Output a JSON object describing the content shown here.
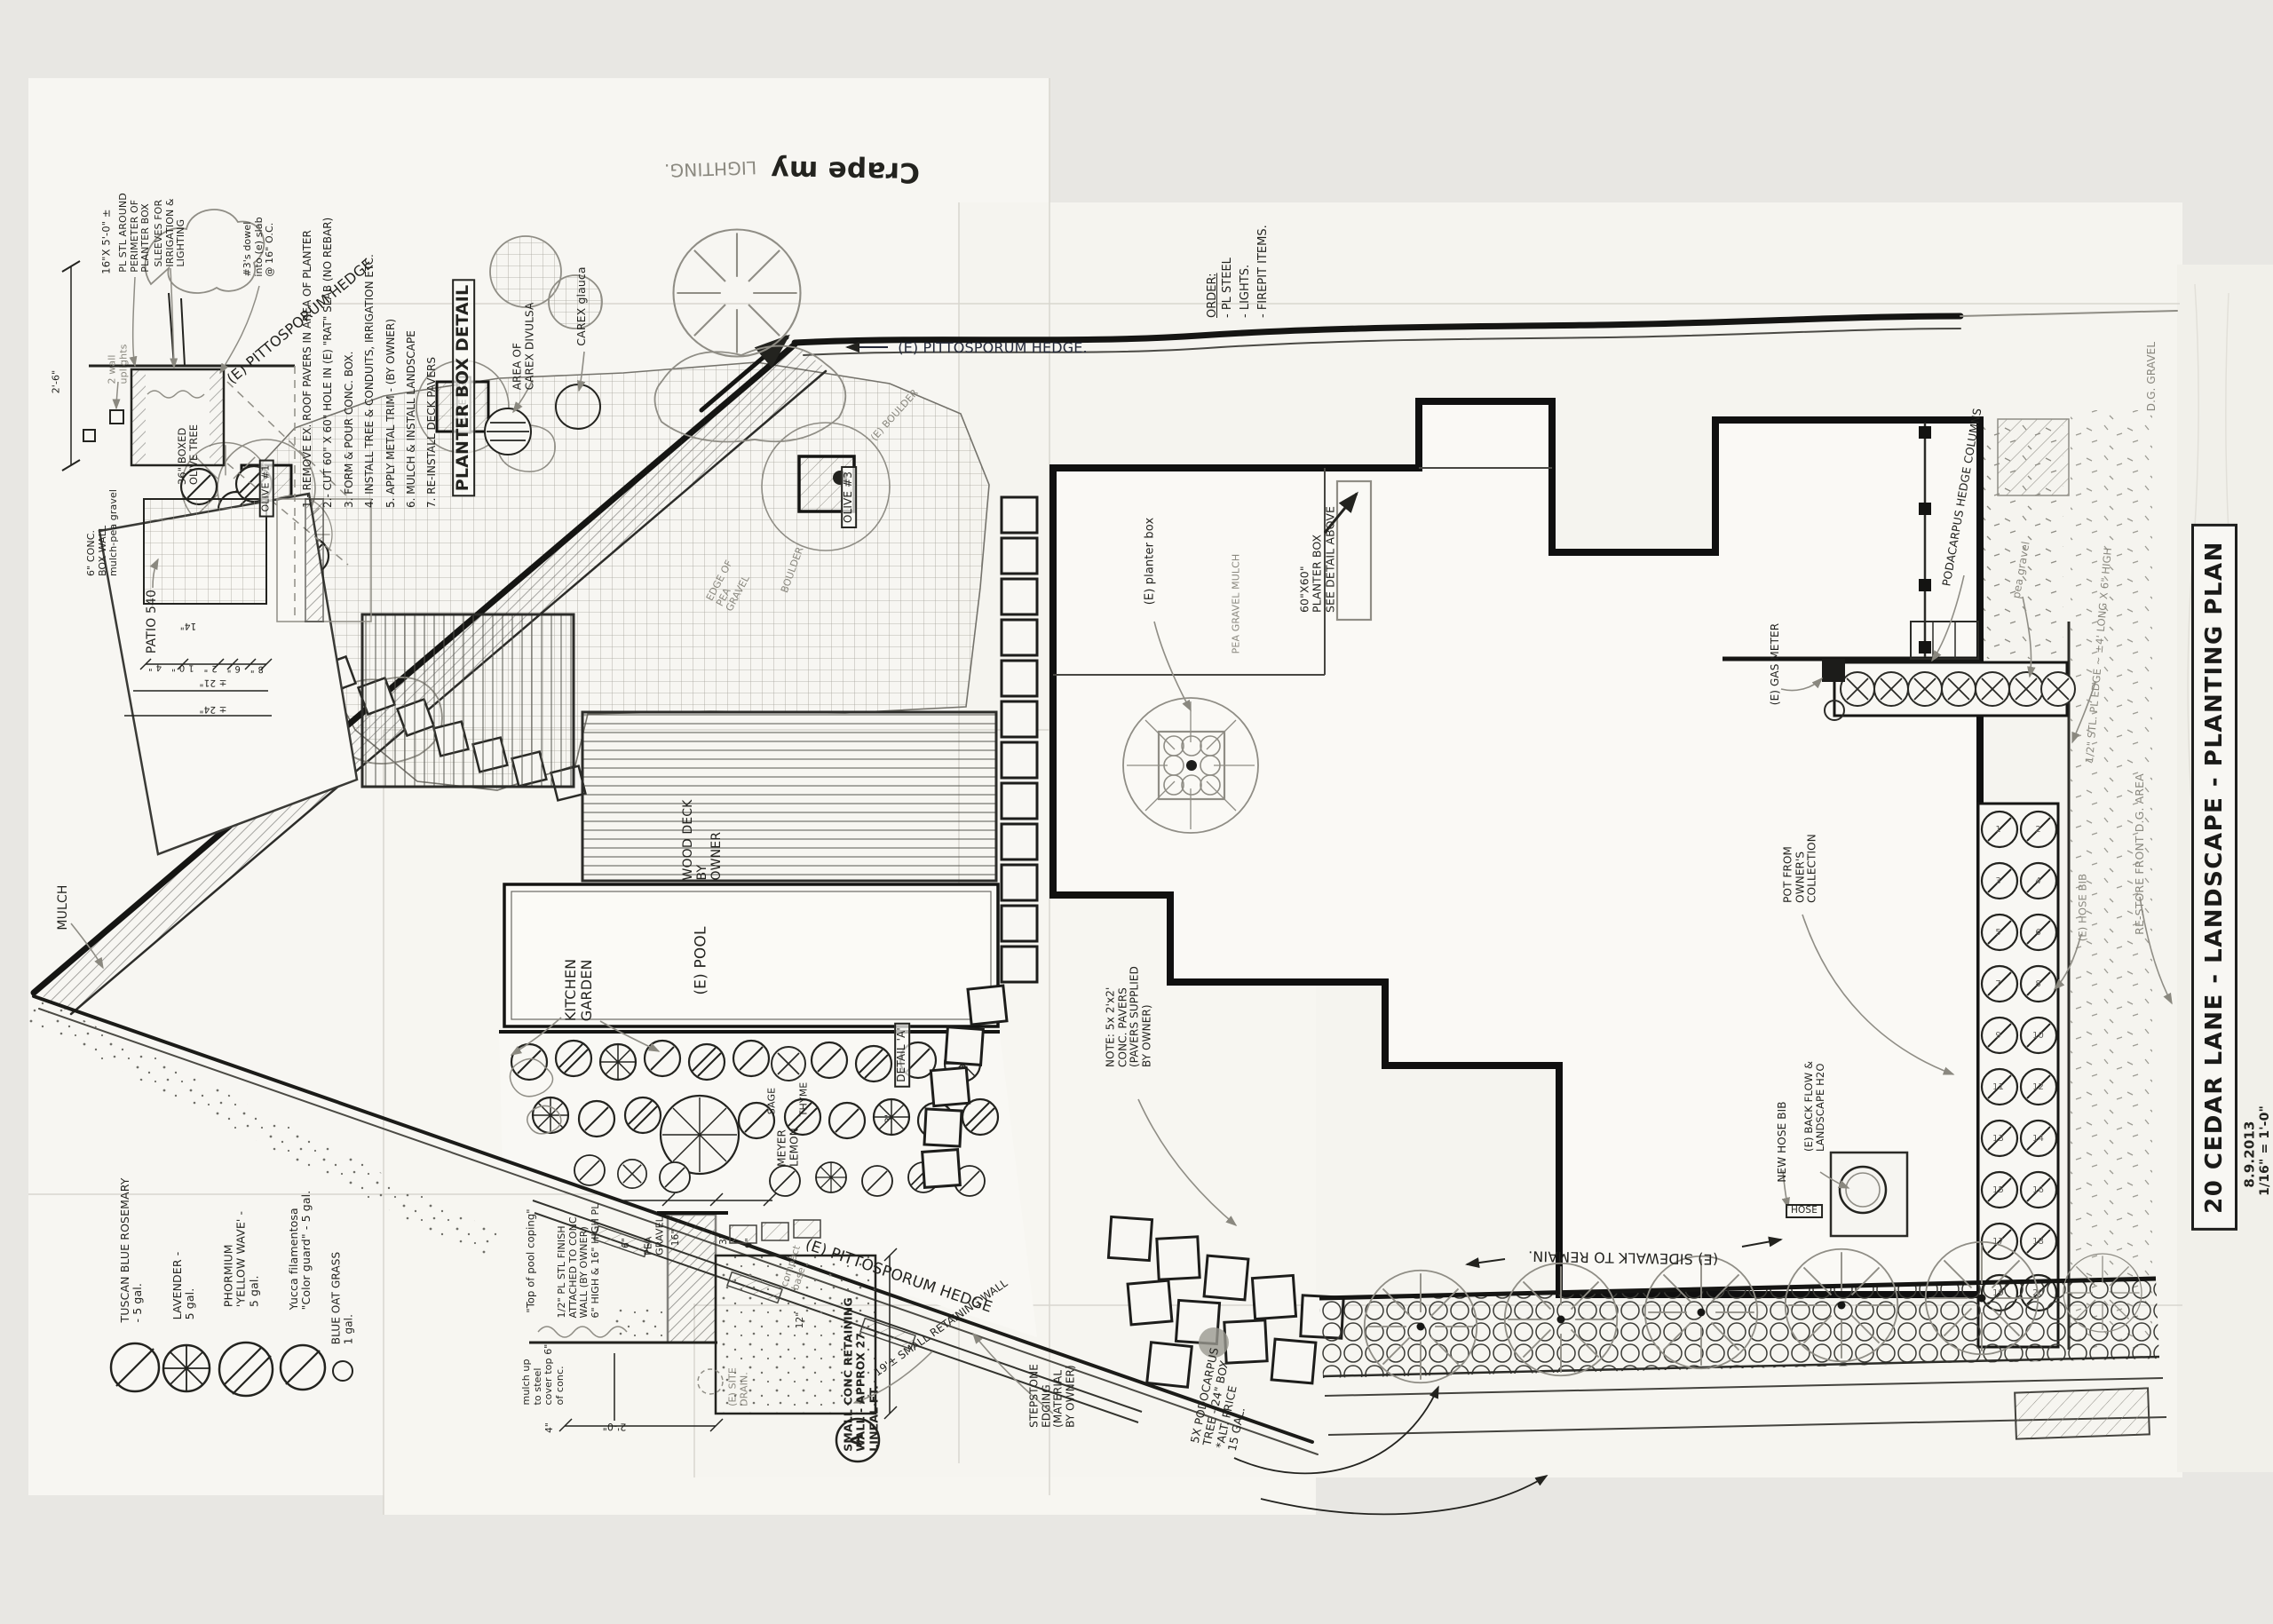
{
  "sheet": {
    "title_block": {
      "title": "20 CEDAR LANE - LANDSCAPE - PLANTING PLAN",
      "date": "8.9.2013",
      "scale": "1/16\" = 1'-0\""
    },
    "palette": {
      "ink": "#23231f",
      "pencil": "#8a887f",
      "paper": "#f6f5f1"
    }
  },
  "planter_box_detail": {
    "title": "PLANTER BOX DETAIL",
    "steps": [
      "1.- REMOVE EX. ROOF PAVERS IN AREA OF PLANTER",
      "2.- CUT 60\" X 60\" HOLE IN (E) \"RAT\" SLAB (NO REBAR)",
      "3. FORM & POUR CONC. BOX.",
      "4. INSTALL TREE & CONDUITS, IRRIGATION ETC.",
      "5. APPLY METAL TRIM - (BY OWNER)",
      "6. MULCH & INSTALL LANDSCAPE",
      "7. RE-INSTALL DECK PAVERS"
    ],
    "callouts": {
      "steel_size": "16\"X 5'-0\" ±",
      "steel_perimeter": "PL STL AROUND\nPERIMETER OF\nPLANTER BOX",
      "sleeves": "SLEEVES FOR\nIRRIGATION &\nLIGHTING",
      "dowels": "#3's dowel\ninto (e) slab\n@ 16\" O.C.",
      "uplights": "2 wall\nuplights",
      "box_wall": "6\" CONC.\nBOX WALL\nmulch-pea gravel",
      "olive_tree": "36\" BOXED\nOLIVE TREE",
      "dim_26": "2'-6\"",
      "dim_21": "± 21\"",
      "dim_24": "± 24\"",
      "dim_14": "14\"",
      "dims_small": "8\"  6\"  2\"  10\"  4\""
    },
    "carex_divulsa": "AREA OF\nCAREX DIVULSA",
    "carex_glauca": "CAREX glauca"
  },
  "retaining_wall_detail": {
    "title": "SMALL CONC RETAINING\nWALL - APPROX 27\nLINEAL FT.",
    "bubble": "A",
    "callouts": {
      "pool_coping": "\"Top of pool coping\"",
      "steel_finish": "1/2\" PL STL FINISH\nATTACHED TO CONC.\nWALL (BY OWNER)\n6\" HIGH & 16\" HIGH PL",
      "mulch_up": "mulch up\nto steel\ncover top 6\"\nof conc.",
      "pea_gravel": "PEA\nGRAVEL",
      "site_drain": "(E) SITE\nDRAIN.",
      "compact_base": "compact\nbase",
      "dim_16": "16\"",
      "dim_6": "6\"",
      "dim_3": "3\"",
      "dim_9": "9\"",
      "dim_12": "12\"",
      "dim_4": "4\"",
      "dim_20": "2'-0\""
    }
  },
  "legend": {
    "items": [
      {
        "symbol": "circle-slash-icon",
        "label": "TUSCAN BLUE ROSEMARY\n- 5 gal."
      },
      {
        "symbol": "circle-spokes-icon",
        "label": "LAVENDER -\n5 gal."
      },
      {
        "symbol": "circle-double-slash-icon",
        "label": "PHORMIUM\n'YELLOW WAVE' -\n5 gal."
      },
      {
        "symbol": "circle-slash-icon",
        "label": "Yucca filamentosa\n\"Color guard\" - 5 gal."
      },
      {
        "symbol": "small-circle-icon",
        "label": "BLUE OAT GRASS\n1 gal."
      }
    ]
  },
  "order_note": {
    "heading": "ORDER:",
    "items": [
      "- PL STEEL",
      "- LIGHTS.",
      "- FIREPIT ITEMS."
    ]
  },
  "east_strip": {
    "numbers": [
      "1",
      "2",
      "3",
      "4",
      "5",
      "6",
      "7",
      "8",
      "9",
      "10",
      "11",
      "12",
      "13",
      "14",
      "15",
      "16",
      "17",
      "18",
      "19",
      "20"
    ]
  },
  "labels": {
    "crape": "Crape my",
    "lighting": "LIGHTING.",
    "hedge_top": "(E) PITTOSPORUM HEDGE.",
    "hedge_left": "(E) PITTOSPORUM HEDGE",
    "hedge_bottom": "(E) PITTOSPORUM HEDGE",
    "sidewalk": "(E) SIDEWALK TO REMAIN.",
    "mulch": "MULCH",
    "patio": "PATIO 540",
    "kitchen_garden": "KITCHEN\nGARDEN",
    "pool": "(E) POOL",
    "wood_deck": "WOOD DECK\nBY\nOWNER",
    "olive1": "OLIVE #1",
    "olive2": "OLIVE #2",
    "olive3": "OLIVE #3",
    "boulder_e": "(E) BOULDER",
    "boulder": "BOULDER",
    "edge_pea_gravel": "EDGE OF\nPEA\nGRAVEL",
    "sage": "SAGE",
    "thyme": "THYME",
    "meyer_lemon": "MEYER\nLEMON",
    "detail_a": "DETAIL 'A'",
    "detail_a_dim": "3'",
    "note_pavers": "NOTE: 5x 2'x2'\nCONC. PAVERS\n(PAVERS SUPPLIED\nBY OWNER)",
    "planter_e": "(E) planter box",
    "pea_gravel_mulch": "PEA GRAVEL MULCH",
    "planter60": "60\"X60\"\nPLANTER BOX\nSEE DETAIL ABOVE",
    "pot_collection": "POT FROM\nOWNER'S\nCOLLECTION",
    "gas_meter": "(E) GAS METER",
    "pod_columns": "PODACARPUS HEDGE COLUMNS",
    "pea_gravel_right": "pea gravel",
    "dg_gravel": "D.G. GRAVEL",
    "steel_edge": "1/2\" STL. PL EDGE ~ ±4' LONG X 6\" HIGH",
    "restore_dg": "RE-STORE FRONT D.G. AREA",
    "hose_bib_e": "(E) HOSE BIB",
    "new_hose_bib": "NEW HOSE BIB",
    "backflow": "(E) BACK FLOW &\nLANDSCAPE H2O",
    "hose": "HOSE",
    "stepstone": "STEPSTONE\nEDGING\n(MATERIAL\nBY OWNER)",
    "podocarpus5": "5X PODOCARPUS\nTREE - 24\" BOX\n*ALT. PRICE\n15 GAL.",
    "wall19": "19'± SMALL RETAINING WALL"
  }
}
